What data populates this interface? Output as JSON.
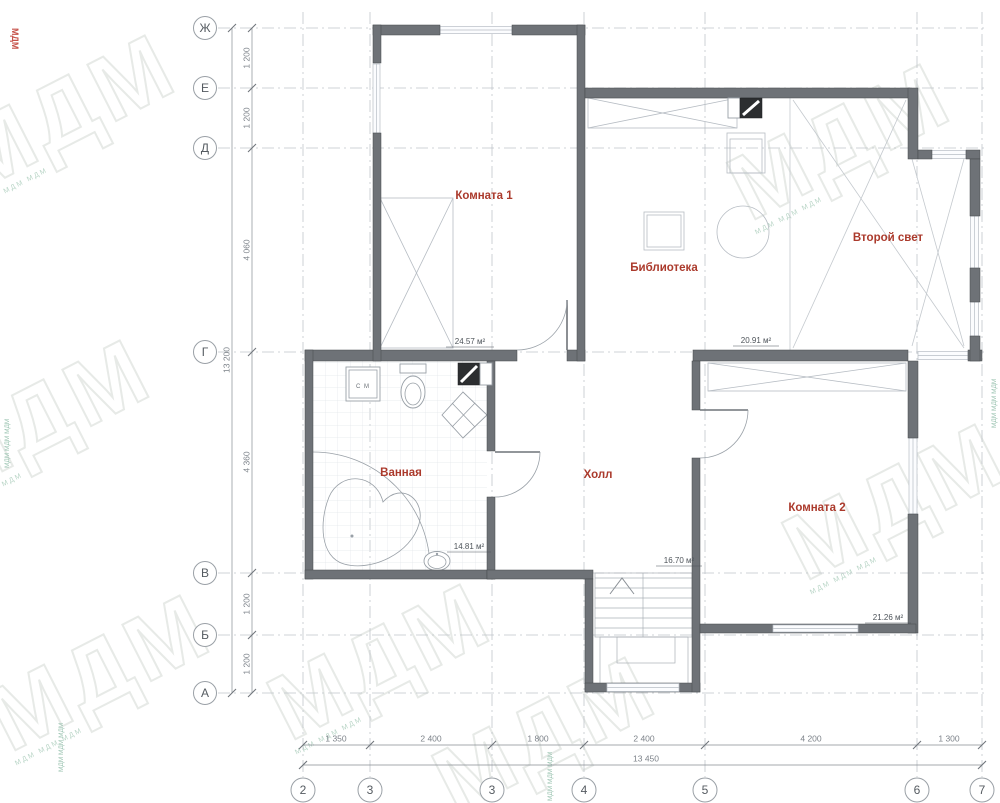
{
  "watermark": {
    "text": "МДМ",
    "small_text": "МДМ МДМ МДМ"
  },
  "axes": {
    "rows": [
      {
        "label": "Ж"
      },
      {
        "label": "Е"
      },
      {
        "label": "Д"
      },
      {
        "label": "Г"
      },
      {
        "label": "В"
      },
      {
        "label": "Б"
      },
      {
        "label": "А"
      }
    ],
    "cols": [
      {
        "label": "2"
      },
      {
        "label": "3"
      },
      {
        "label": "3"
      },
      {
        "label": "4"
      },
      {
        "label": "5"
      },
      {
        "label": "6"
      },
      {
        "label": "7"
      }
    ]
  },
  "dimensions": {
    "left": {
      "total": "13 200",
      "segments": [
        "1 200",
        "1 200",
        "4 060",
        "4 360",
        "1 200",
        "1 200"
      ]
    },
    "bottom": {
      "total": "13 450",
      "segments": [
        "1 350",
        "2 400",
        "1 800",
        "2 400",
        "4 200",
        "1 300"
      ]
    }
  },
  "rooms": {
    "komnata1": {
      "name": "Комната 1",
      "area": "24.57 м²"
    },
    "biblioteka": {
      "name": "Библиотека",
      "area": "20.91 м²"
    },
    "vtoroy_svet": {
      "name": "Второй свет"
    },
    "vannaya": {
      "name": "Ванная",
      "area": "14.81 м²"
    },
    "holl": {
      "name": "Холл",
      "area": "16.70 м²"
    },
    "komnata2": {
      "name": "Комната 2",
      "area": "21.26 м²"
    }
  },
  "fixtures": {
    "washing_machine": "С М"
  }
}
